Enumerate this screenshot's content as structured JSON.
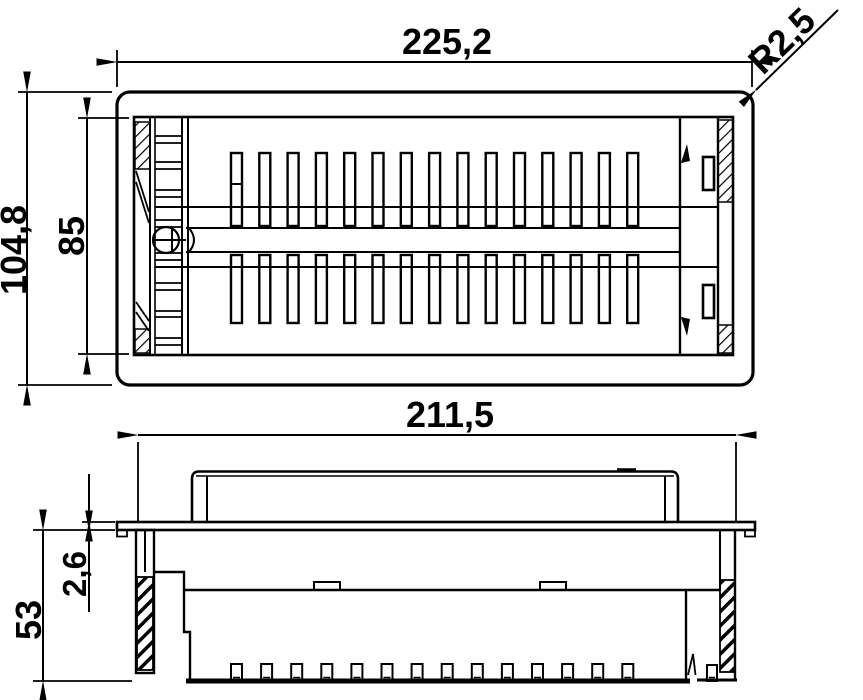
{
  "drawing": {
    "dimensions": {
      "top_width": "225,2",
      "corner_radius": "R2,5",
      "outer_height": "104,8",
      "cutout_height": "85",
      "body_width": "211,5",
      "flange_thickness": "2,6",
      "mounting_depth": "53"
    },
    "counts": {
      "top_vent_slots": 15,
      "bottom_vent_slots": 15,
      "side_teeth": 14
    },
    "colors": {
      "line": "#000000",
      "background": "#ffffff"
    }
  }
}
